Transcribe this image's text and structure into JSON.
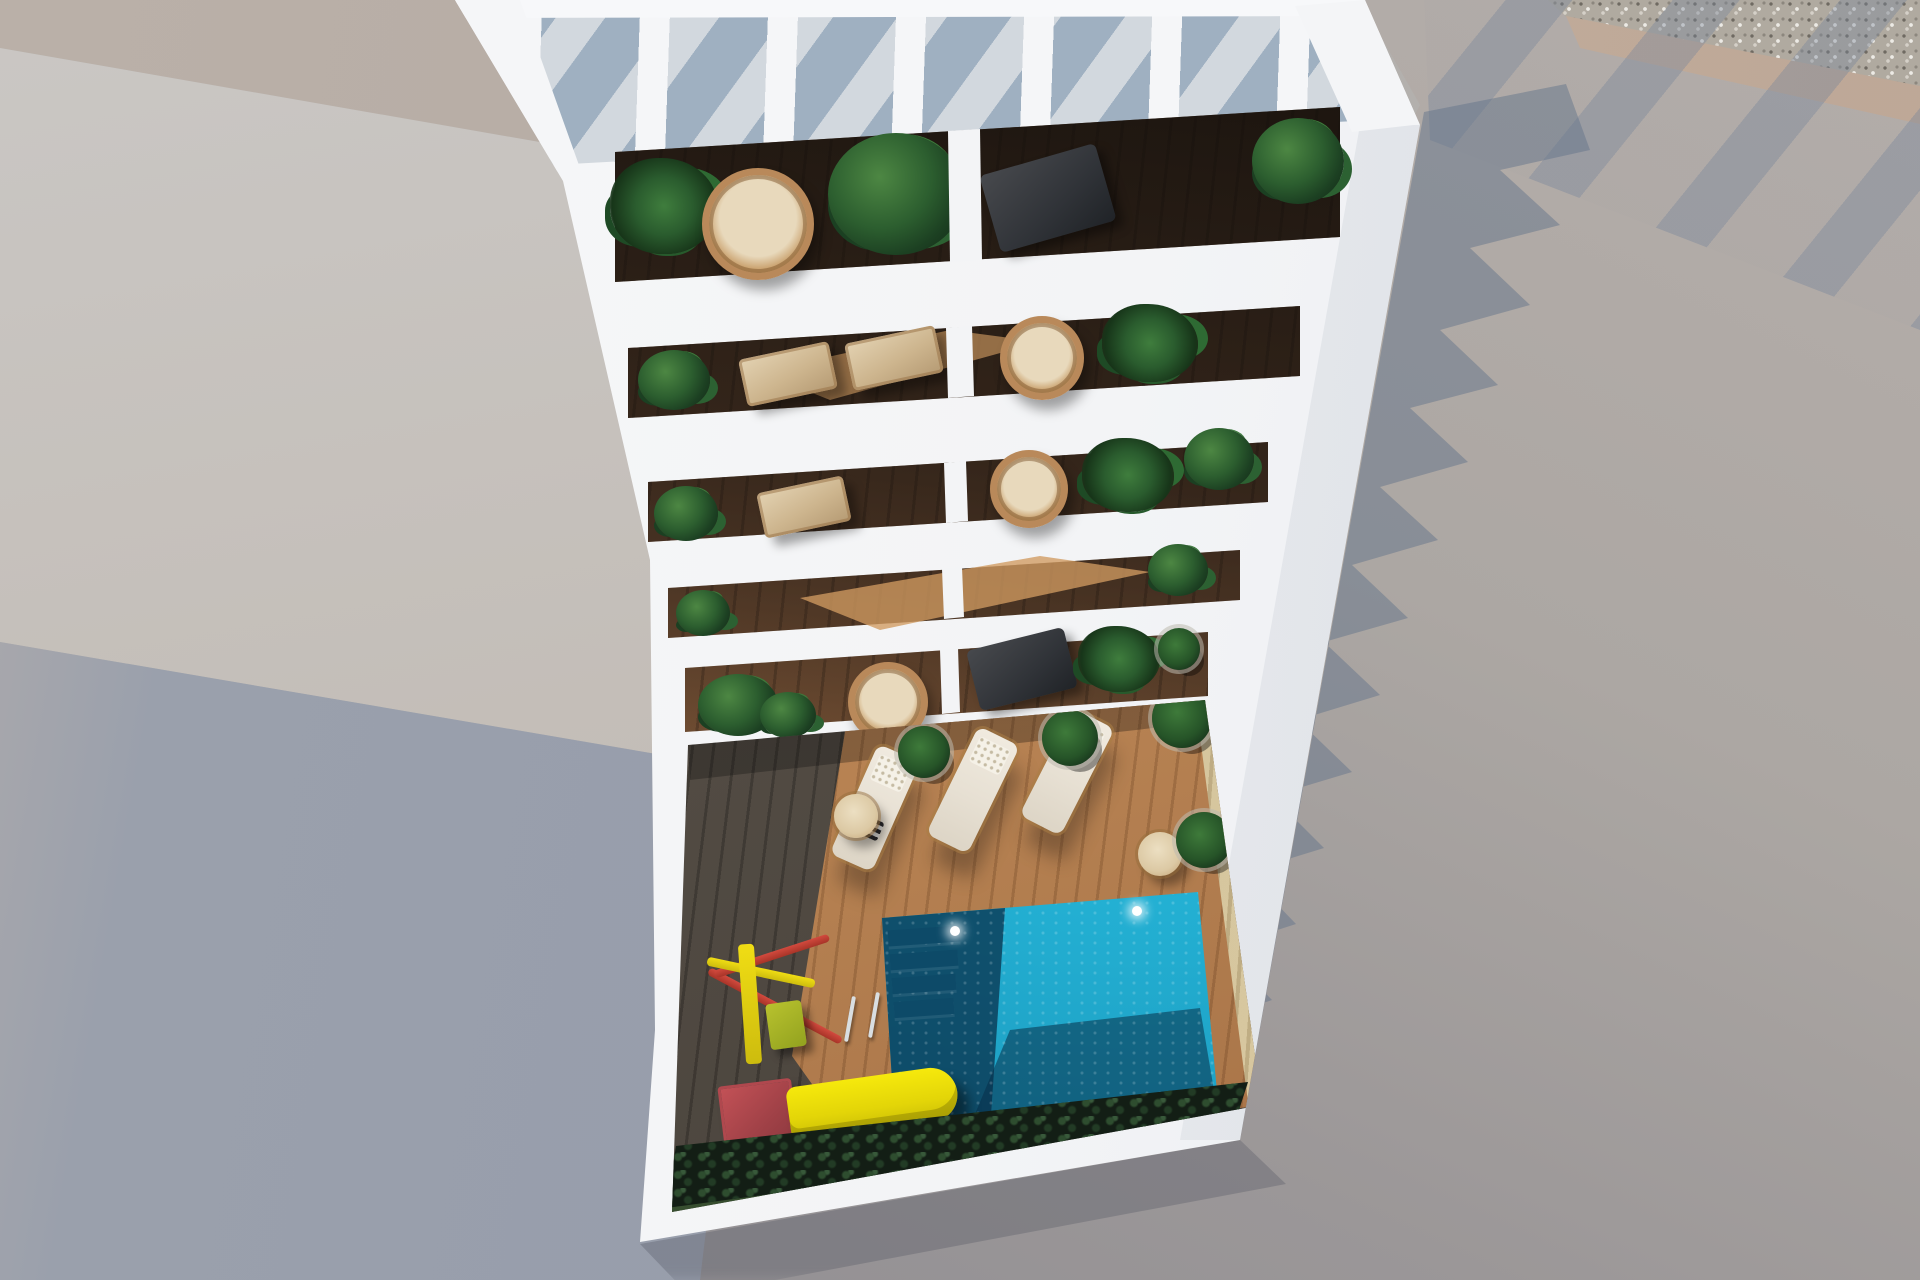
{
  "scene": {
    "title": "Aerial top-down 3D architectural render of a white apartment building with planted balconies and a courtyard pool area",
    "view": "top-down aerial, sunny daylight with hard shadows cast to the right"
  },
  "building": {
    "material": "white concrete",
    "roof_pergola": {
      "slats": 8,
      "cast_stripes": true
    },
    "balcony_floors": 5,
    "balconies_per_floor": 2,
    "balcony_floor_material": "dark wood decking",
    "balcony_items": [
      "palm plant",
      "hanging wicker egg chair",
      "monstera plant",
      "gray sling deck chair",
      "beige lounge chairs",
      "wicker chairs",
      "potted plants"
    ]
  },
  "courtyard": {
    "deck_material": "wood planks, half in building shadow",
    "pool": {
      "underwater_lights": 2,
      "steps": 4,
      "ladder": true
    },
    "sun_loungers": 3,
    "side_tables": 2,
    "potted_plants": 4,
    "playground": {
      "slide": true,
      "climbing_frame": true,
      "slide_color": "#f2e20d",
      "frame_colors": [
        "#c23b33",
        "#e8d312"
      ]
    },
    "hedge_strip": true,
    "grass_strip": true
  },
  "surroundings": {
    "pavement": "concrete in two tones",
    "gravel_strip_top_right": true,
    "neighboring_wall_bottom_left": true,
    "building_shadow": "jagged balcony teeth cast on right pavement"
  },
  "colors": {
    "building_white": "#f3f4f6",
    "pavement_warm": "#aca7a3",
    "pavement_cool": "#8e8c91",
    "shadow_blue_gray": "#8d96a6",
    "concrete_tan": "#b6aca4",
    "gravel_base": "#b2aba0",
    "curb_tan": "#c3ac9c",
    "balcony_wood_lit": "#ad7a4b",
    "balcony_wood_dark": "#54402f",
    "courtyard_deck_shadow": "#544d45",
    "courtyard_deck_sunlit": "#bc8756",
    "inner_wall_straw": "#d5c59d",
    "plant_green": "#2c5e2f",
    "plant_dark_green": "#1c4022",
    "wicker_tan": "#b9895a",
    "lounger_beige": "#e7e0d3",
    "pool_turquoise": "#24b2d5",
    "pool_deep_blue": "#0f506e",
    "pool_shadow": "#0a2d46",
    "slide_yellow": "#f2e20d",
    "playground_red": "#c23b33",
    "hedge_dark_green": "#131e15",
    "grass_green": "#3c5433"
  }
}
